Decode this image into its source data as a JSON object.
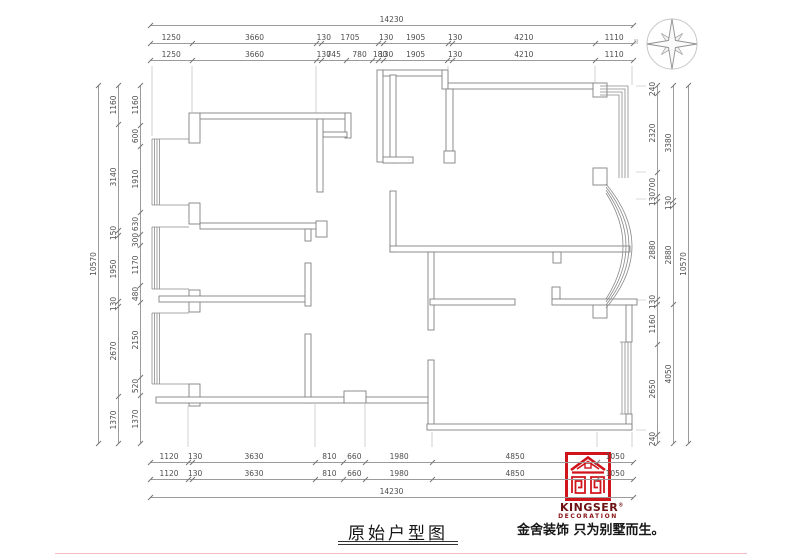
{
  "title": {
    "text": "原始户型图"
  },
  "branding": {
    "logo_name": "KINGSER",
    "logo_reg": "®",
    "logo_sub": "DECORATION",
    "slogan": "金舍装饰 只为别墅而生。",
    "logo_color": "#cf141b",
    "text_color": "#6d1113"
  },
  "compass": {
    "mark": "II"
  },
  "drawing_colors": {
    "wall": "#828282",
    "dimension_line": "#9b9b9b",
    "dimension_text": "#4e4e4e"
  },
  "dimensions": {
    "top": {
      "total": [
        14230
      ],
      "row1": [
        1250,
        3660,
        130,
        1705,
        130,
        1905,
        130,
        4210,
        1110
      ],
      "row2": [
        1250,
        3660,
        130,
        745,
        780,
        180,
        130,
        1905,
        130,
        4210,
        1110
      ]
    },
    "bottom": {
      "row1": [
        1120,
        130,
        3630,
        810,
        660,
        1980,
        4850,
        1050
      ],
      "row2": [
        1120,
        130,
        3630,
        810,
        660,
        1980,
        4850,
        1050
      ],
      "total": [
        14230
      ]
    },
    "left": {
      "outer": [
        10570
      ],
      "middle": [
        1160,
        3140,
        150,
        1950,
        130,
        2670,
        1370
      ],
      "inner": [
        1160,
        600,
        1910,
        630,
        300,
        1170,
        480,
        2150,
        520,
        1370
      ]
    },
    "right": {
      "inner": [
        240,
        2320,
        700,
        130,
        2880,
        130,
        1160,
        2650,
        240
      ],
      "middle": [
        3380,
        130,
        2880,
        4050
      ],
      "outer": [
        10570
      ]
    }
  }
}
